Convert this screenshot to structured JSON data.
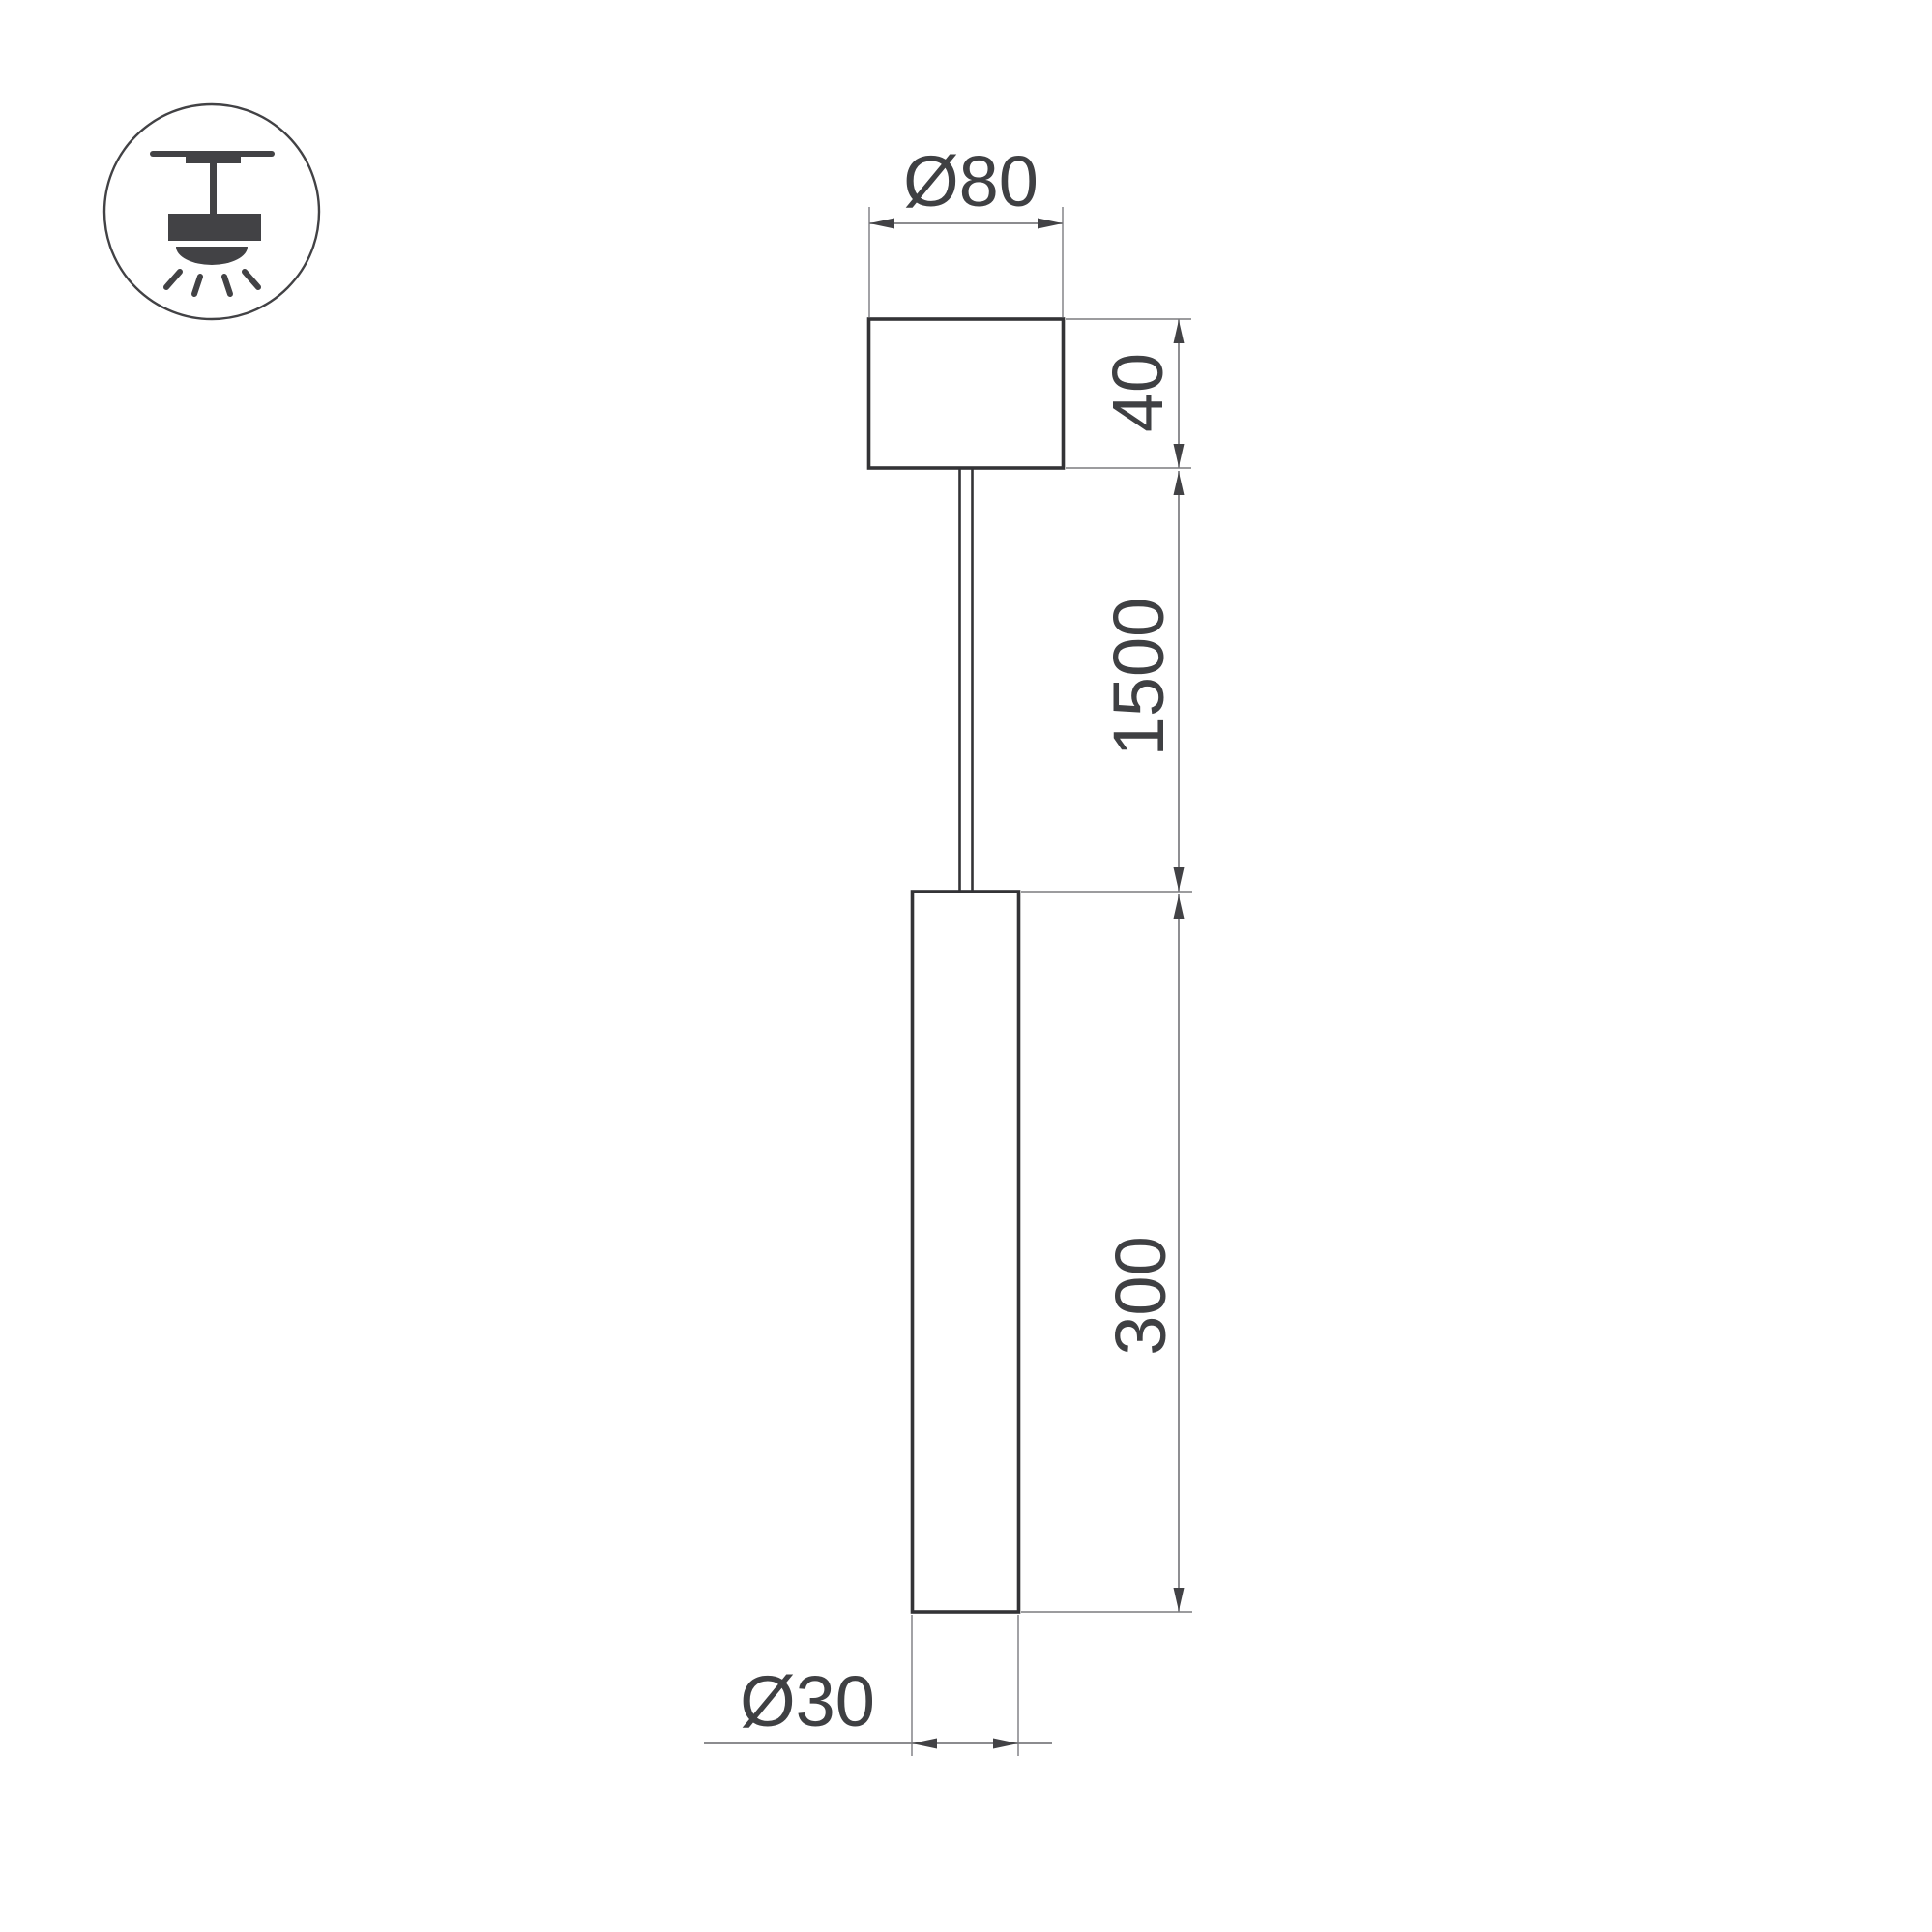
{
  "drawing_title": "pendant-luminaire-dimension-drawing",
  "mount_icon": {
    "name": "ceiling-pendant-mount-icon"
  },
  "dimensions": {
    "canopy_diameter": "Ø80",
    "canopy_height": "40",
    "suspension_length": "1500",
    "body_length": "300",
    "body_diameter": "Ø30"
  },
  "colors": {
    "background": "#ffffff",
    "outline": "#333336",
    "dimension_line": "#7b7b7f",
    "arrow": "#424245",
    "text": "#3f4043",
    "icon": "#424245"
  }
}
